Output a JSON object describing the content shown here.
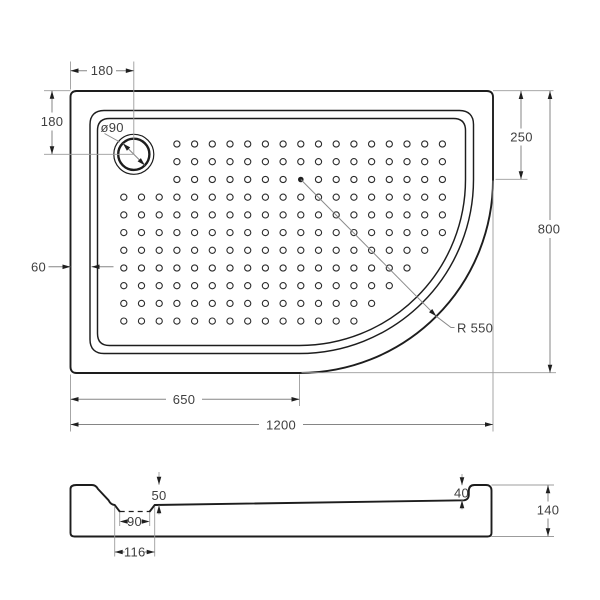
{
  "drawing": {
    "title": "shower-tray-technical-drawing",
    "colors": {
      "line": "#1d1d1d",
      "dimension": "#8a8a8a",
      "text": "#3f3f3f",
      "background": "#ffffff"
    },
    "plan": {
      "drain_offset_top": "180",
      "drain_offset_left": "180",
      "corner_offset_top": "250",
      "overall_depth": "800",
      "rim_width": "60",
      "corner_center_x": "650",
      "overall_width": "1200",
      "corner_radius": "R 550",
      "drain_diameter": "ø90"
    },
    "section": {
      "depth_at_drain": "50",
      "depth_at_edge": "40",
      "recess_bottom_width": "90",
      "recess_top_width": "116",
      "overall_height": "140"
    }
  }
}
